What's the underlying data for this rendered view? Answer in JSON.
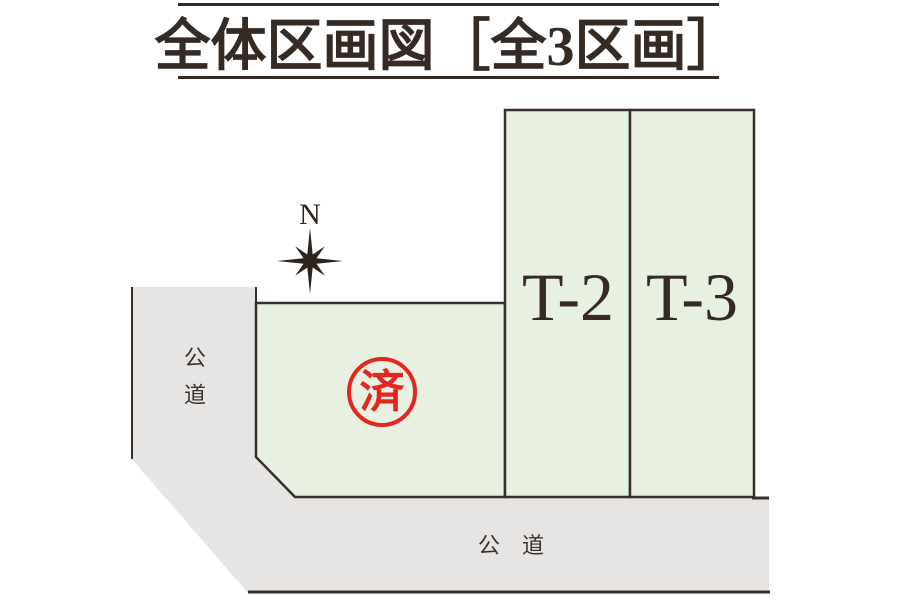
{
  "title": {
    "text": "全体区画図［全3区画］"
  },
  "compass": {
    "label": "N"
  },
  "plots": {
    "sold": {
      "stamp_label": "済"
    },
    "t2": {
      "label": "T-2"
    },
    "t3": {
      "label": "T-3"
    }
  },
  "roads": {
    "left": {
      "label": "公道"
    },
    "bottom": {
      "label": "公　道"
    }
  },
  "colors": {
    "plot_fill": "#e8f0e1",
    "road_fill": "#e6e5e4",
    "outline": "#3a2f28",
    "title_text": "#362b24",
    "stamp_red": "#e5261f",
    "compass": "#2e241e",
    "background": "#ffffff"
  }
}
